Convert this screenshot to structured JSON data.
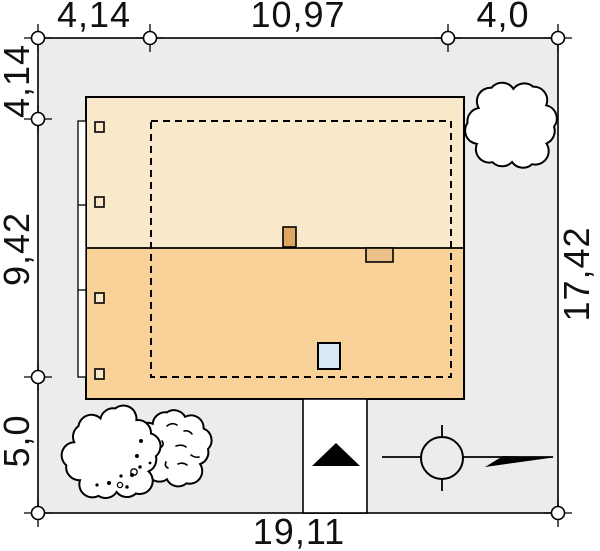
{
  "plan": {
    "type": "site-plan",
    "dimensions": {
      "top": [
        "4,14",
        "10,97",
        "4,0"
      ],
      "left": [
        "4,14",
        "9,42",
        "5,0"
      ],
      "right": [
        "17,42"
      ],
      "bottom": [
        "19,11"
      ]
    },
    "colors": {
      "plot_fill": "#ECECEC",
      "outline": "#000000",
      "roof_upper": "#FAE8CA",
      "roof_lower": "#F8D299",
      "chimney_dark": "#DCA763",
      "chimney_light": "#EBC189",
      "skylight": "#D7E9F6",
      "window_fill": "#FAE8CA",
      "tree_fill": "#FFFFFF",
      "driveway_fill": "#FFFFFF",
      "symbol_color": "#000000"
    },
    "icons": [
      "tree-icon",
      "entrance-arrow-icon",
      "north-compass-icon",
      "boundary-marker-icon"
    ]
  }
}
